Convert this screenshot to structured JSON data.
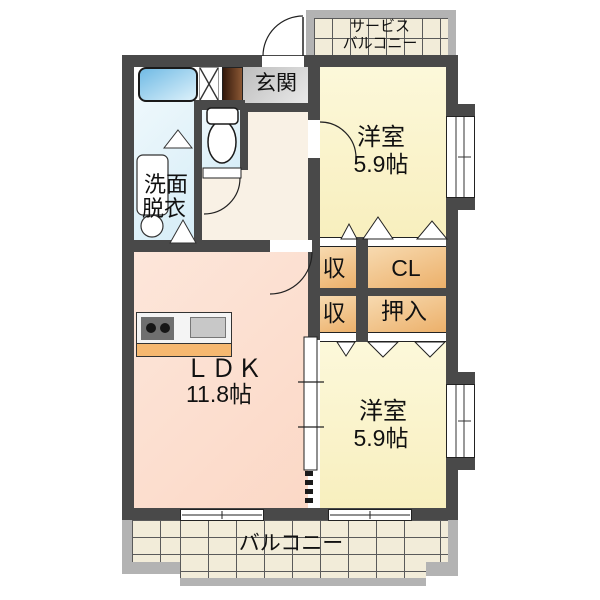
{
  "floor_plan": {
    "service_balcony": {
      "line1": "サービス",
      "line2": "バルコニー"
    },
    "entrance": {
      "label": "玄関"
    },
    "bedroom_top": {
      "name": "洋室",
      "area": "5.9帖"
    },
    "washroom": {
      "line1": "洗面",
      "line2": "脱衣"
    },
    "closets": {
      "upper_left": "収",
      "upper_right": "CL",
      "lower_left": "収",
      "lower_right": "押入"
    },
    "ldk": {
      "name": "ＬＤＫ",
      "area": "11.8帖"
    },
    "bedroom_bottom": {
      "name": "洋室",
      "area": "5.9帖"
    },
    "balcony": {
      "label": "バルコニー"
    },
    "colors": {
      "wall": "#494949",
      "balcony_frame": "#b3b3b3",
      "balcony_tile": "#f2ecd9",
      "ldk_floor": "#fbd8c6",
      "bedroom_floor": "#f9f2c8",
      "hall_floor": "#f9f1e5",
      "wet_floor": "#dcf0f8",
      "closet": "#edb36e",
      "entrance_tile": "#d2d2d2",
      "bathtub": "#7fc3e8",
      "kitchen_strip": "#f6b870",
      "shoe_cabinet": "#5a3014"
    }
  }
}
